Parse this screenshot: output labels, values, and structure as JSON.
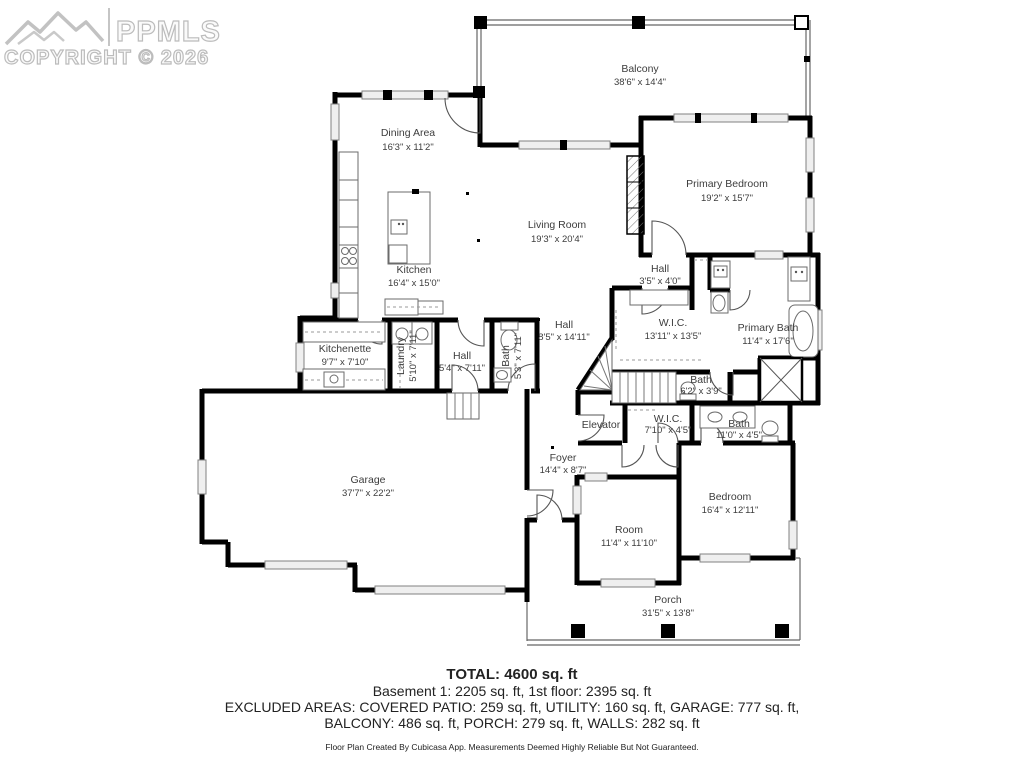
{
  "watermark": {
    "logo_text": "PPMLS",
    "copyright": "COPYRIGHT © 2026",
    "logo_icon": "mountain-range"
  },
  "rooms": {
    "balcony": {
      "name": "Balcony",
      "dims": "38'6\" x 14'4\""
    },
    "dining_area": {
      "name": "Dining Area",
      "dims": "16'3\" x 11'2\""
    },
    "primary_bedroom": {
      "name": "Primary Bedroom",
      "dims": "19'2\" x 15'7\""
    },
    "living_room": {
      "name": "Living Room",
      "dims": "19'3\" x 20'4\""
    },
    "kitchen": {
      "name": "Kitchen",
      "dims": "16'4\" x 15'0\""
    },
    "hall_upper": {
      "name": "Hall",
      "dims": "3'5\" x 4'0\""
    },
    "wic_main": {
      "name": "W.I.C.",
      "dims": "13'11\" x 13'5\""
    },
    "primary_bath": {
      "name": "Primary Bath",
      "dims": "11'4\" x 17'6\""
    },
    "hall_main": {
      "name": "Hall",
      "dims": "8'5\" x 14'11\""
    },
    "kitchenette": {
      "name": "Kitchenette",
      "dims": "9'7\" x 7'10\""
    },
    "laundry": {
      "name": "Laundry",
      "dims": "5'10\" x 7'11\""
    },
    "hall_small": {
      "name": "Hall",
      "dims": "5'4\" x 7'11\""
    },
    "bath_small": {
      "name": "Bath",
      "dims": "5'3\" x 7'11\""
    },
    "bath_mid": {
      "name": "Bath",
      "dims": "6'2\" x 3'9\""
    },
    "elevator": {
      "name": "Elevator"
    },
    "wic_lower": {
      "name": "W.I.C.",
      "dims": "7'10\" x 4'5\""
    },
    "bath_lower": {
      "name": "Bath",
      "dims": "11'0\" x 4'5\""
    },
    "foyer": {
      "name": "Foyer",
      "dims": "14'4\" x 8'7\""
    },
    "garage": {
      "name": "Garage",
      "dims": "37'7\" x 22'2\""
    },
    "room": {
      "name": "Room",
      "dims": "11'4\" x 11'10\""
    },
    "bedroom": {
      "name": "Bedroom",
      "dims": "16'4\" x 12'11\""
    },
    "porch": {
      "name": "Porch",
      "dims": "31'5\" x 13'8\""
    }
  },
  "summary": {
    "total": "TOTAL: 4600 sq. ft",
    "line2": "Basement 1: 2205 sq. ft, 1st floor: 2395 sq. ft",
    "line3": "EXCLUDED AREAS: COVERED PATIO: 259 sq. ft, UTILITY: 160 sq. ft, GARAGE: 777 sq. ft,",
    "line4": "BALCONY: 486 sq. ft, PORCH: 279 sq. ft, WALLS: 282 sq. ft",
    "disclaimer": "Floor Plan Created By Cubicasa App. Measurements Deemed Highly Reliable But Not Guaranteed."
  },
  "colors": {
    "wall": "#000000",
    "window_fill": "#efefef",
    "watermark": "#bcbcbc",
    "label_text": "#3d3d3d",
    "footer_text": "#222222"
  }
}
